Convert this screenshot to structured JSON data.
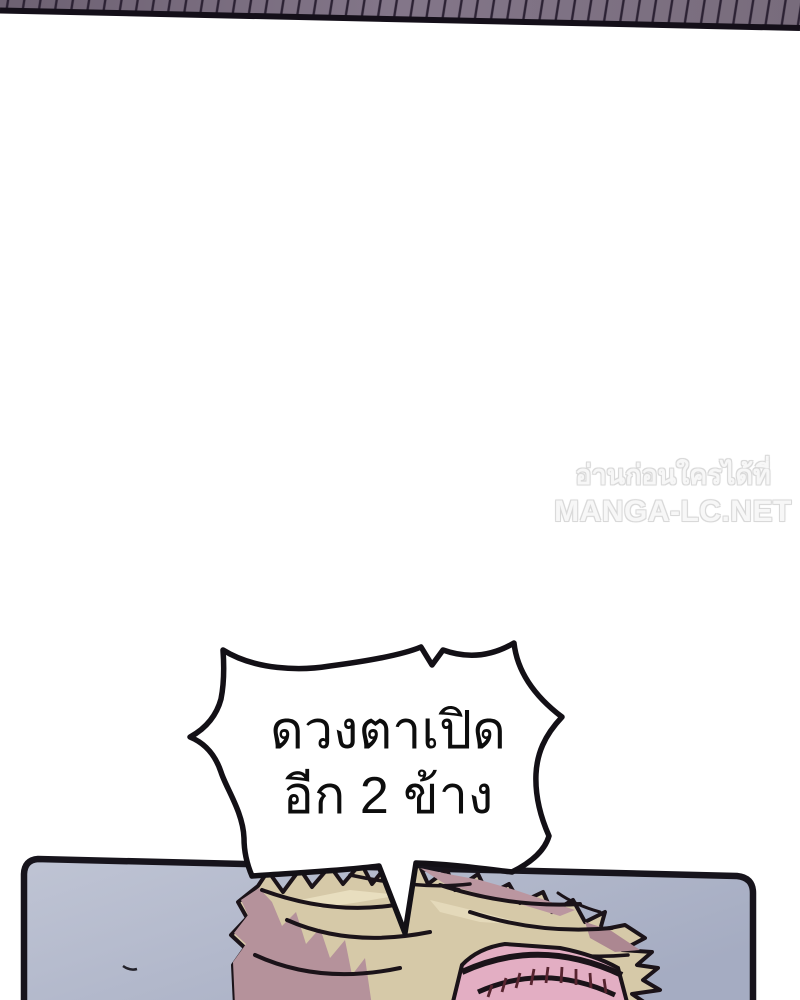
{
  "page": {
    "kind": "manga webtoon page"
  },
  "watermark": {
    "line1": "อ่านก่อนใครได้ที่",
    "line2": "MANGA-LC.NET"
  },
  "speech_bubble": {
    "line1": "ดวงตาเปิด",
    "line2": "อีก 2 ข้าง"
  },
  "colors": {
    "background": "#ffffff",
    "ceiling_left": "#6d6172",
    "ceiling_mid": "#837689",
    "ceiling_right": "#786c7c",
    "ceiling_edge": "#140f19",
    "hatch_line": "#2c2234",
    "panel_border": "#17141c",
    "sky_top": "#bfc4d4",
    "sky_bottom": "#a5acc2",
    "hair_tan": "#d6c9a8",
    "hair_shadow": "#b5929b",
    "hair_shadow2": "#bb96a0",
    "hair_highlight": "#e8debf",
    "face_pink": "#e3aec3",
    "face_hatch": "#57242f",
    "line_art": "#1b1319",
    "bubble_fill": "#ffffff",
    "bubble_stroke": "#131016",
    "bubble_text": "#0d0d0d",
    "watermark_text": "#f7f7f7"
  }
}
